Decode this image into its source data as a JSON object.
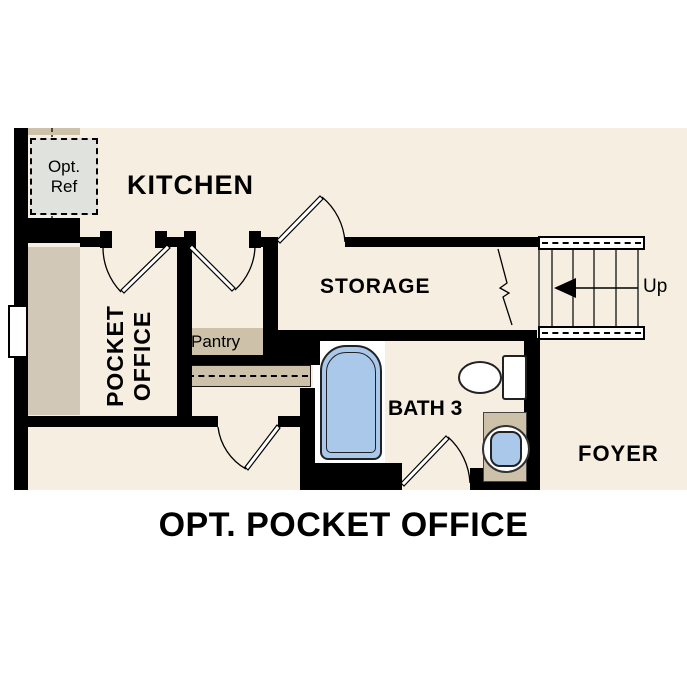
{
  "title": "OPT. POCKET OFFICE",
  "rooms": {
    "kitchen": {
      "label": "KITCHEN"
    },
    "storage": {
      "label": "STORAGE"
    },
    "pocket_office": {
      "label1": "POCKET",
      "label2": "OFFICE"
    },
    "pantry": {
      "label": "Pantry"
    },
    "bath": {
      "label": "BATH 3"
    },
    "foyer": {
      "label": "FOYER"
    }
  },
  "fixtures": {
    "opt_ref": {
      "label1": "Opt.",
      "label2": "Ref"
    },
    "stairs": {
      "direction_label": "Up"
    }
  },
  "colors": {
    "background": "#ffffff",
    "floor": "#f6eee1",
    "wall": "#000000",
    "casework": "#cdc1a9",
    "desk": "#d2c8b8",
    "tub_fill": "#a9c8ea",
    "opt_ref_fill": "#e0e2de"
  }
}
